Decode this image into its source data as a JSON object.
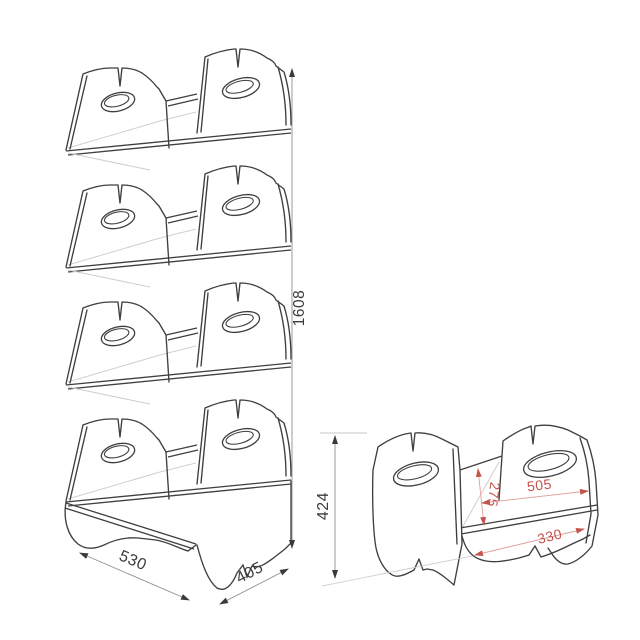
{
  "drawing": {
    "type": "furniture technical drawing - stackable bin shelf",
    "views": {
      "stacked_unit": {
        "description": "four stacked bin modules, isometric view",
        "dimensions": {
          "height": "1608",
          "width": "530",
          "depth": "405"
        }
      },
      "single_unit": {
        "description": "single bin module, isometric view",
        "dimensions": {
          "height": "424",
          "inner_depth": "275",
          "inner_width": "505",
          "base_length": "330"
        }
      }
    },
    "colors": {
      "outline": "#3f3f3f",
      "light_line": "#cfcfcf",
      "dim_line": "#8e8e8e",
      "arrow": "#3a3a3a",
      "red_text": "#c4544e",
      "red_line": "#e0a09a",
      "background": "#ffffff"
    }
  }
}
